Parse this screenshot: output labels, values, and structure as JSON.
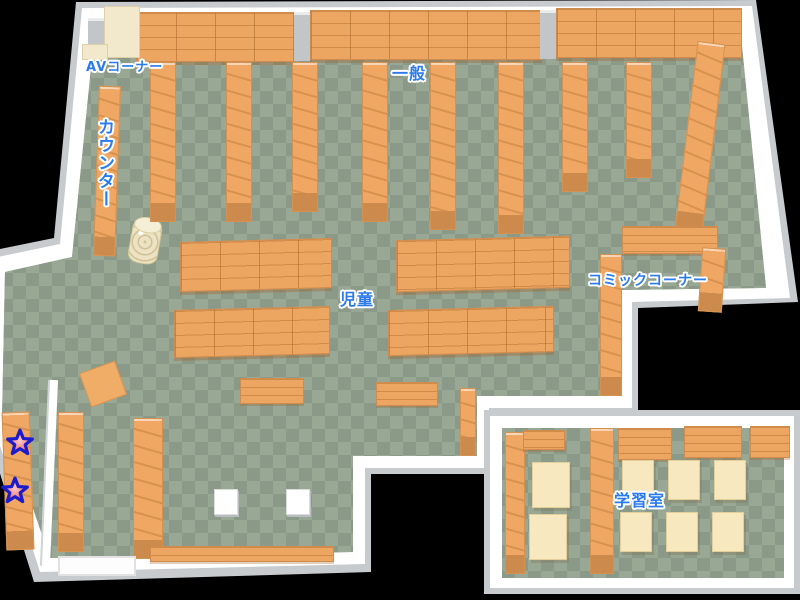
{
  "map": {
    "type": "library-floor-map",
    "areas": {
      "av_corner": {
        "label": "AVコーナー"
      },
      "counter": {
        "label": "カウンター"
      },
      "general": {
        "label": "一般"
      },
      "children": {
        "label": "児童"
      },
      "comic_corner": {
        "label": "コミックコーナー"
      },
      "study_room": {
        "label": "学習室"
      }
    },
    "markers": {
      "star_count": 2,
      "description": "two star markers on west wall shelf"
    },
    "colors": {
      "background": "#000000",
      "floor_light": "#99a795",
      "floor_dark": "#8b9a88",
      "shelf": "#efa763",
      "shelf_end": "#cd8a4d",
      "wall": "#ffffff",
      "wall_shadow": "#c7cbce",
      "table": "#f7e8bf",
      "label_text": "#2b7bed",
      "star_fill": "#f28a8a",
      "star_outline": "#1c1ccd"
    }
  }
}
